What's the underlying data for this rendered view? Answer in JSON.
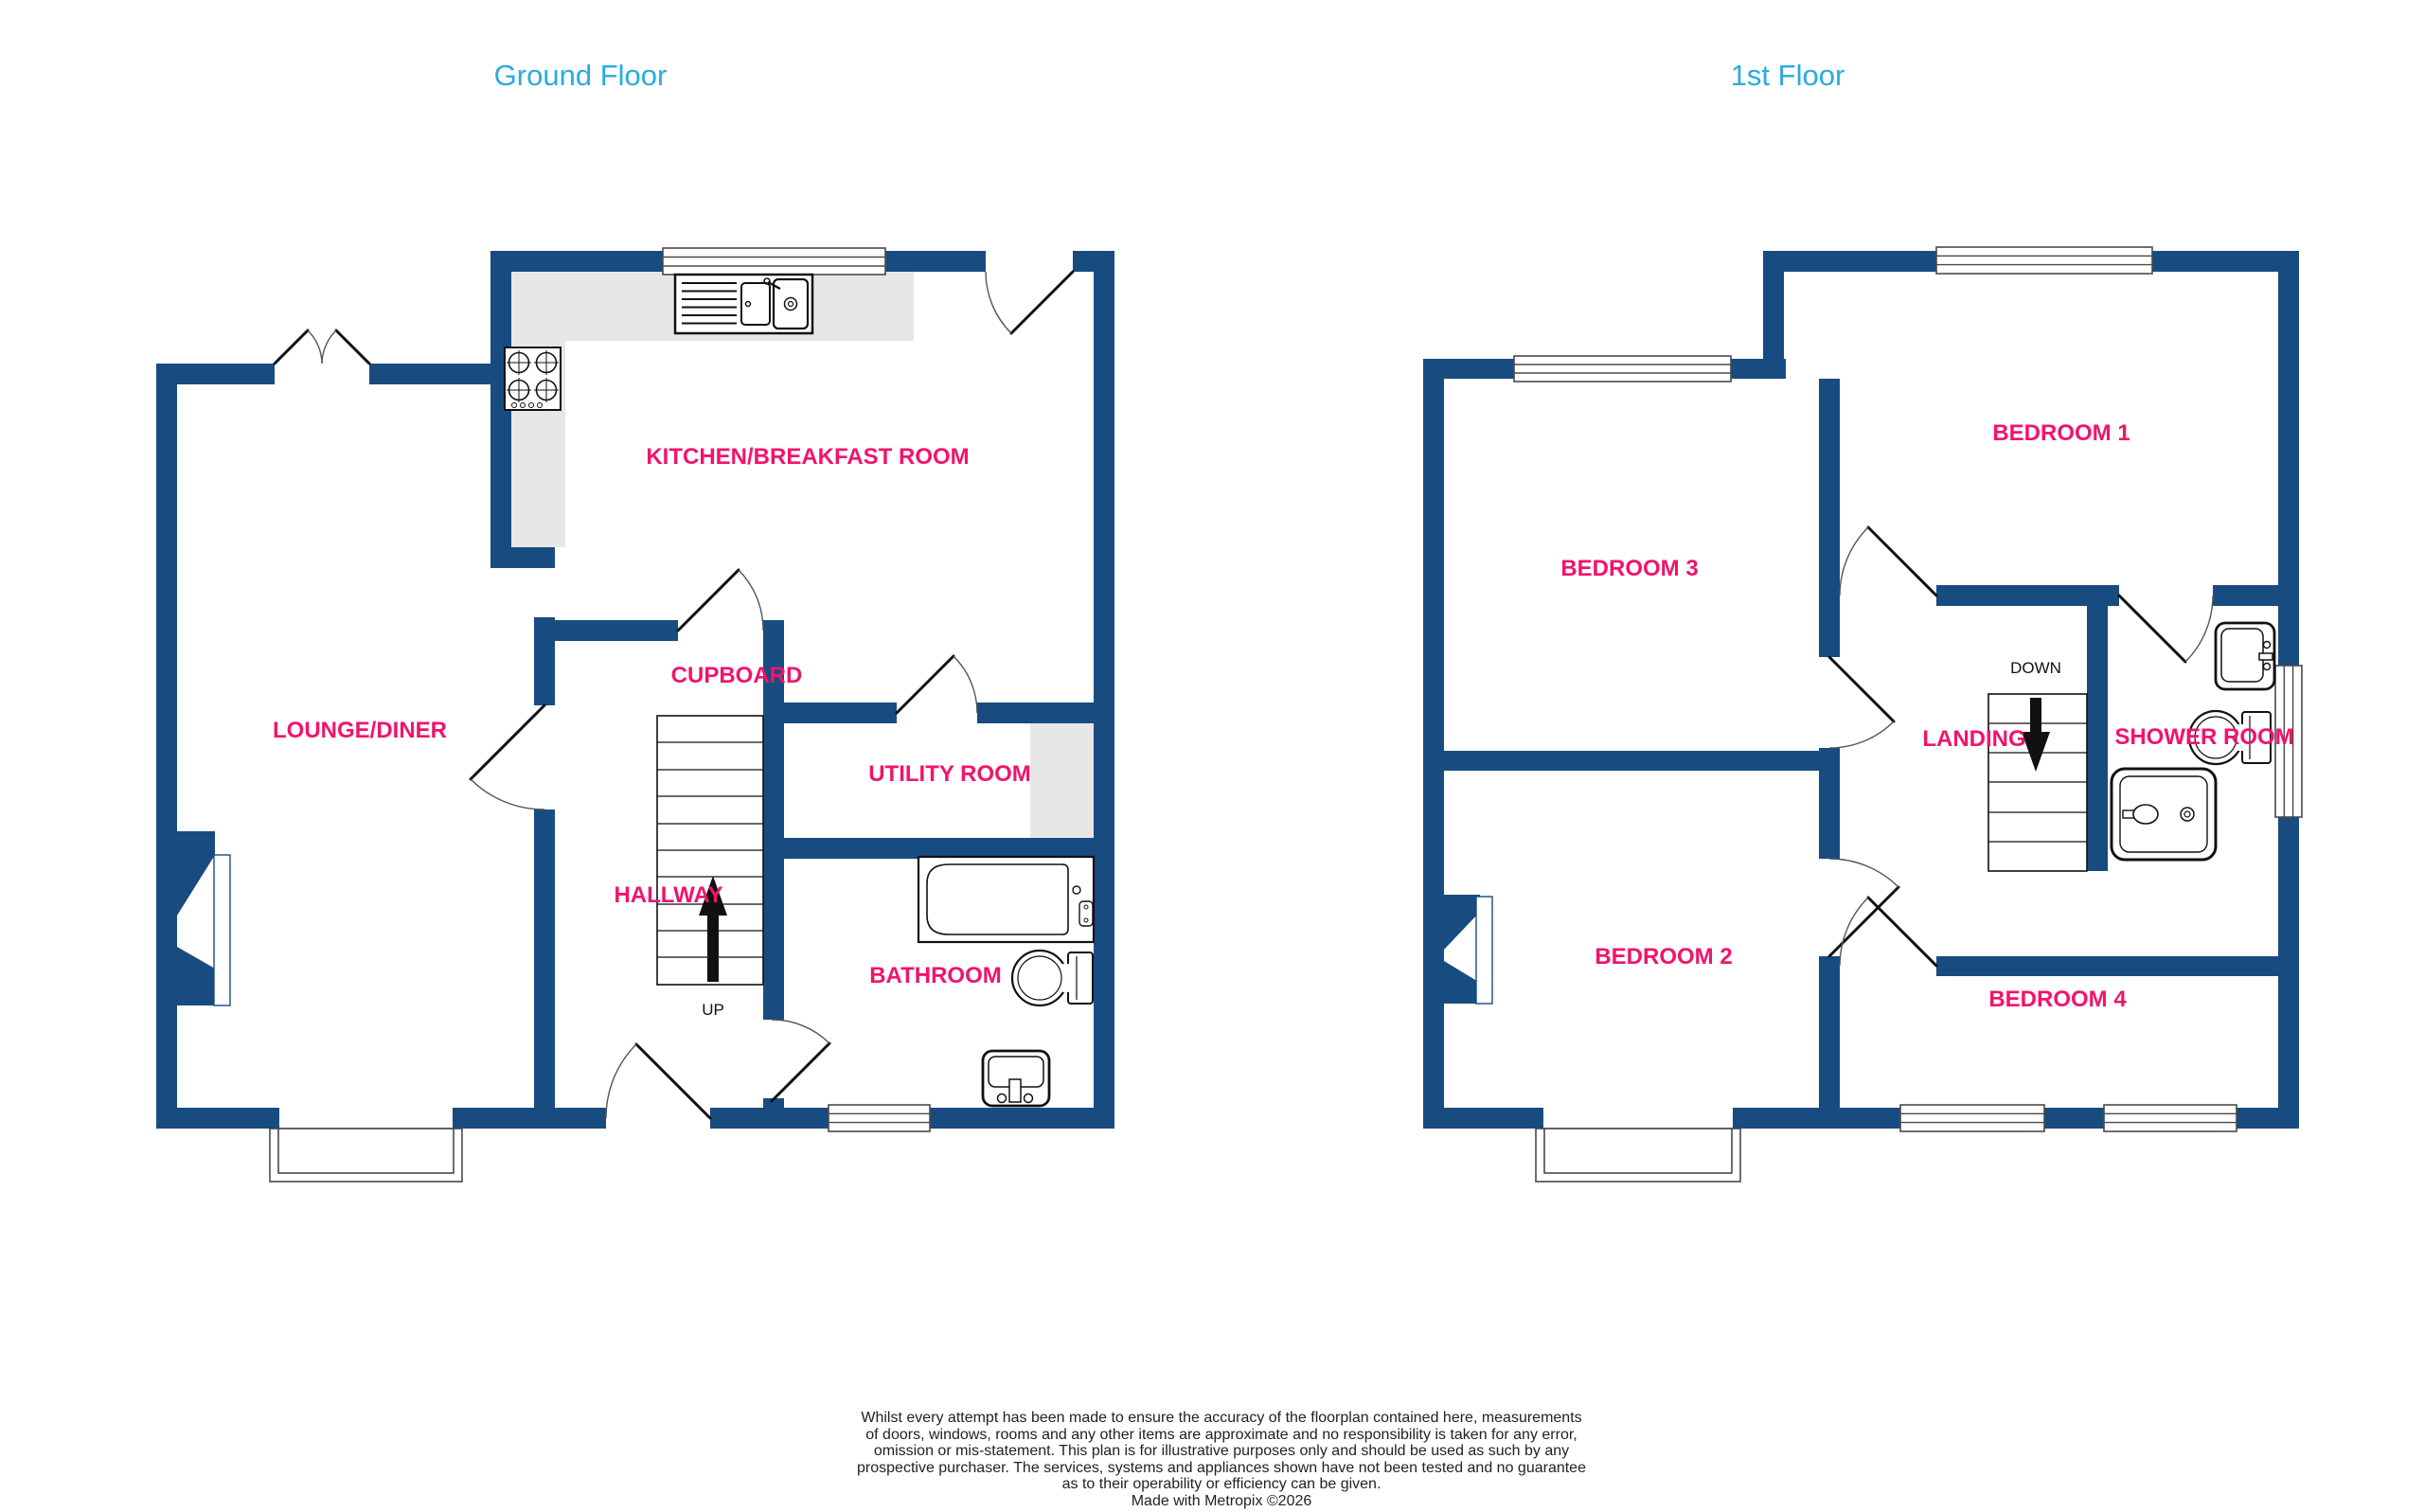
{
  "colors": {
    "wall": "#184C80",
    "label": "#F0146C",
    "title": "#29ABE2",
    "counter": "#E7E7E7"
  },
  "floors": {
    "ground": {
      "title": "Ground Floor",
      "rooms": [
        {
          "label": "LOUNGE/DINER"
        },
        {
          "label": "KITCHEN/BREAKFAST ROOM"
        },
        {
          "label": "CUPBOARD"
        },
        {
          "label": "UTILITY ROOM"
        },
        {
          "label": "HALLWAY"
        },
        {
          "label": "BATHROOM"
        }
      ],
      "stair_label": "UP"
    },
    "first": {
      "title": "1st Floor",
      "rooms": [
        {
          "label": "BEDROOM 1"
        },
        {
          "label": "BEDROOM 3"
        },
        {
          "label": "LANDING"
        },
        {
          "label": "SHOWER ROOM"
        },
        {
          "label": "BEDROOM 2"
        },
        {
          "label": "BEDROOM 4"
        }
      ],
      "stair_label": "DOWN"
    }
  },
  "disclaimer": {
    "lines": [
      "Whilst every attempt has been made to ensure the accuracy of the floorplan contained here, measurements",
      "of doors, windows, rooms and any other items are approximate and no responsibility is taken for any error,",
      "omission or mis-statement. This plan is for illustrative purposes only and should be used as such by any",
      "prospective purchaser. The services, systems and appliances shown have not been tested and no guarantee",
      "as to their operability or efficiency can be given.",
      "Made with Metropix ©2026"
    ]
  }
}
